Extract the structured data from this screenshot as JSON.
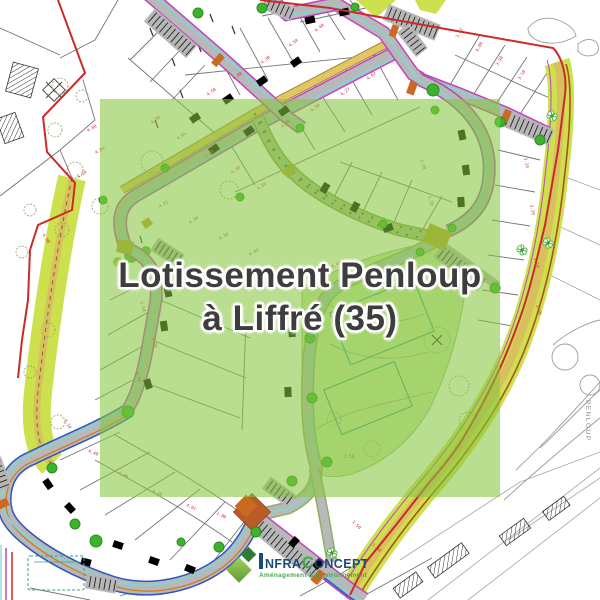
{
  "overlay": {
    "title_line1": "Lotissement Penloup",
    "title_line2": "à Liffré (35)",
    "tint": "rgba(134,198,64,0.58)",
    "text_color": "#3d3d3d"
  },
  "logo": {
    "brand": "InfraConcept",
    "part_nfra": "NFRA",
    "part_c": "C",
    "part_oncept": "ONCEPT",
    "tagline": "Aménagement & Environnement",
    "navy": "#1d4b77",
    "green": "#3faa4b",
    "diamond_dark": "#2f7d32",
    "diamond_light": "#7cb342"
  },
  "map": {
    "territory_label": "PENLOUP",
    "colors": {
      "boundary_red": "#cc2a2a",
      "road_gray": "#b8b8b8",
      "road_edge_magenta": "#c243c2",
      "road_edge_blue": "#2f55c0",
      "path_cyan": "#7fd6d6",
      "greenway_chartreuse": "#cde14f",
      "path_tan": "#d9c05e",
      "junction_orange": "#c96a20",
      "plaza_olive": "#b9a22e",
      "tree_green": "#3db32d",
      "building_teal": "#2e8b8b",
      "park_green": "#cfe7ad",
      "dimension_red": "#d03030"
    },
    "dimension_labels": [
      {
        "t": "4.08",
        "x": 88,
        "y": 132,
        "r": -30
      },
      {
        "t": "4.06",
        "x": 96,
        "y": 154,
        "r": -30
      },
      {
        "t": "4.10",
        "x": 78,
        "y": 178,
        "r": -30
      },
      {
        "t": "4.08",
        "x": 42,
        "y": 235,
        "r": 55
      },
      {
        "t": "4.50",
        "x": 208,
        "y": 96,
        "r": -36
      },
      {
        "t": "4.08",
        "x": 234,
        "y": 80,
        "r": -36
      },
      {
        "t": "4.30",
        "x": 262,
        "y": 64,
        "r": -36
      },
      {
        "t": "4.50",
        "x": 290,
        "y": 47,
        "r": -36
      },
      {
        "t": "4.40",
        "x": 316,
        "y": 32,
        "r": -38
      },
      {
        "t": "4.27",
        "x": 342,
        "y": 96,
        "r": -38
      },
      {
        "t": "4.50",
        "x": 312,
        "y": 112,
        "r": -38
      },
      {
        "t": "4.30",
        "x": 282,
        "y": 128,
        "r": -36
      },
      {
        "t": "4.62",
        "x": 368,
        "y": 80,
        "r": -38
      },
      {
        "t": "3.02",
        "x": 458,
        "y": 38,
        "r": -62
      },
      {
        "t": "4.08",
        "x": 478,
        "y": 52,
        "r": -62
      },
      {
        "t": "3.98",
        "x": 498,
        "y": 66,
        "r": -60
      },
      {
        "t": "3.10",
        "x": 520,
        "y": 80,
        "r": -58
      },
      {
        "t": "3.10",
        "x": 524,
        "y": 158,
        "r": 78
      },
      {
        "t": "3.20",
        "x": 530,
        "y": 205,
        "r": 78
      },
      {
        "t": "3.10",
        "x": 534,
        "y": 258,
        "r": 75
      },
      {
        "t": "3.20",
        "x": 536,
        "y": 305,
        "r": 74
      },
      {
        "t": "4.50",
        "x": 152,
        "y": 124,
        "r": -36
      },
      {
        "t": "4.01",
        "x": 178,
        "y": 140,
        "r": -36
      },
      {
        "t": "4.48",
        "x": 206,
        "y": 158,
        "r": -34
      },
      {
        "t": "4.30",
        "x": 232,
        "y": 174,
        "r": -34
      },
      {
        "t": "4.50",
        "x": 258,
        "y": 190,
        "r": -32
      },
      {
        "t": "4.01",
        "x": 160,
        "y": 208,
        "r": -32
      },
      {
        "t": "4.30",
        "x": 190,
        "y": 224,
        "r": -32
      },
      {
        "t": "4.50",
        "x": 220,
        "y": 240,
        "r": -30
      },
      {
        "t": "4.40",
        "x": 250,
        "y": 256,
        "r": -30
      },
      {
        "t": "1.90",
        "x": 300,
        "y": 282,
        "r": -25
      },
      {
        "t": "4.40",
        "x": 332,
        "y": 268,
        "r": -22
      },
      {
        "t": "3.10",
        "x": 420,
        "y": 160,
        "r": 70
      },
      {
        "t": "3.20",
        "x": 428,
        "y": 196,
        "r": 75
      },
      {
        "t": "1.50",
        "x": 140,
        "y": 302,
        "r": 72
      },
      {
        "t": "4.30",
        "x": 152,
        "y": 338,
        "r": 76
      },
      {
        "t": "4.48",
        "x": 136,
        "y": 372,
        "r": 76
      },
      {
        "t": "4.10",
        "x": 64,
        "y": 420,
        "r": 60
      },
      {
        "t": "4.48",
        "x": 88,
        "y": 452,
        "r": 22
      },
      {
        "t": "4.40",
        "x": 118,
        "y": 474,
        "r": 24
      },
      {
        "t": "4.30",
        "x": 152,
        "y": 492,
        "r": 24
      },
      {
        "t": "4.01",
        "x": 186,
        "y": 506,
        "r": 26
      },
      {
        "t": "1.90",
        "x": 216,
        "y": 514,
        "r": 28
      },
      {
        "t": "1.50",
        "x": 344,
        "y": 458,
        "r": 0
      },
      {
        "t": "1.50",
        "x": 352,
        "y": 522,
        "r": 45
      },
      {
        "t": "1.90",
        "x": 372,
        "y": 545,
        "r": 45
      }
    ]
  }
}
